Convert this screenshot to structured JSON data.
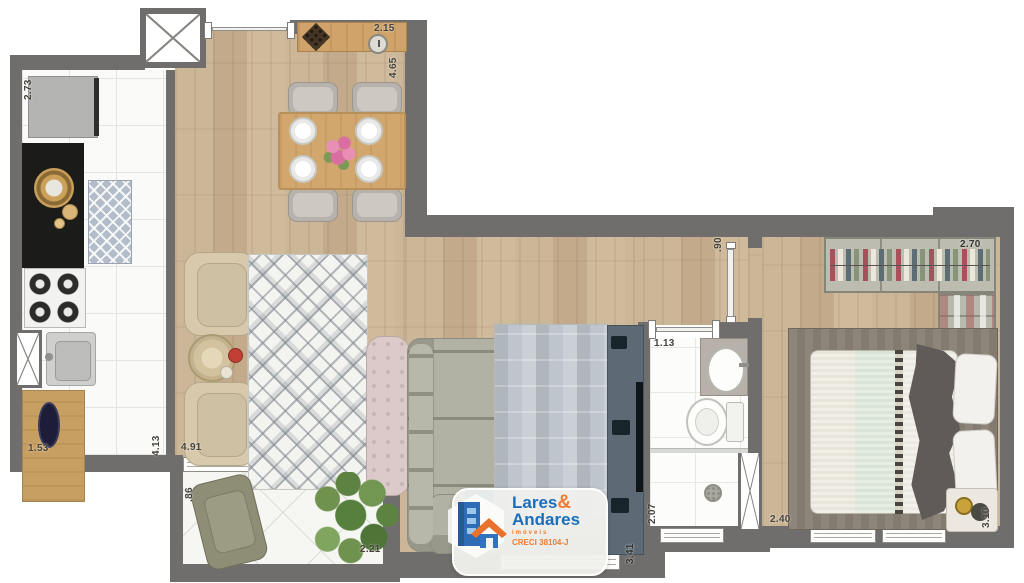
{
  "plan_labels": {
    "kitchen_width": "2.73",
    "sideboard_width": "2.15",
    "dining_depth": "4.65",
    "kitchen_counter": "1.53",
    "kitchen_depth": "4.13",
    "living_width": "4.91",
    "balcony_depth": ".86",
    "balcony_width": "2.21",
    "living_section": "2.43",
    "living_depth": "3.41",
    "bathroom_door": "1.13",
    "bathroom_depth": "2.07",
    "bedroom_door": ".90",
    "wardrobe_width": "2.70",
    "bedroom_width": "2.40",
    "bedroom_depth": "3.10"
  },
  "logo": {
    "brand_first": "Lares",
    "brand_amp": "&",
    "brand_second": "Andares",
    "tagline": "imóveis",
    "license": "CRECI 38104-J"
  },
  "colors": {
    "wall": "#6f6e6c",
    "wood_floor": "#c9b294",
    "kitchen_tile": "#fafaf8",
    "brand_blue": "#1b6fba",
    "brand_orange": "#ef7b30"
  },
  "icons": {
    "shaft-x-icon": "crossed-box duct/shaft symbol",
    "building-logo-icon": "blue building with orange roof house"
  }
}
